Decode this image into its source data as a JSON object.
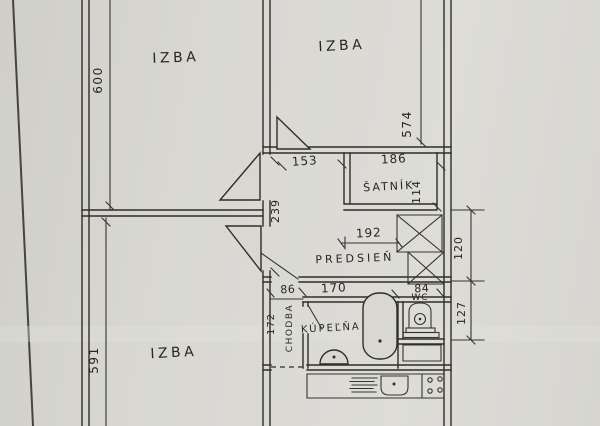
{
  "rooms": {
    "izba_top_left": "IZBA",
    "izba_top_right": "IZBA",
    "izba_bottom_left": "IZBA",
    "satnik": "ŠATNÍK",
    "predsien": "PREDSIEŇ",
    "kupelna": "KÚPEĽŇA",
    "chodba": "CHODBA",
    "wc": "WC"
  },
  "dimensions": {
    "izba_top_left_depth": "600",
    "izba_top_right_depth": "574",
    "izba_bottom_left_depth": "591",
    "predsien_nook_width": "153",
    "satnik_width": "186",
    "satnik_depth": "114",
    "predsien_nook_depth": "239",
    "predsien_width": "192",
    "shaft_recess_depth": "120",
    "wc_depth": "127",
    "chodba_width": "86",
    "kupelna_width": "170",
    "wc_width": "84",
    "chodba_length": "172"
  },
  "colors": {
    "paper": "#d8d7d2",
    "ink": "#2e2d28"
  }
}
